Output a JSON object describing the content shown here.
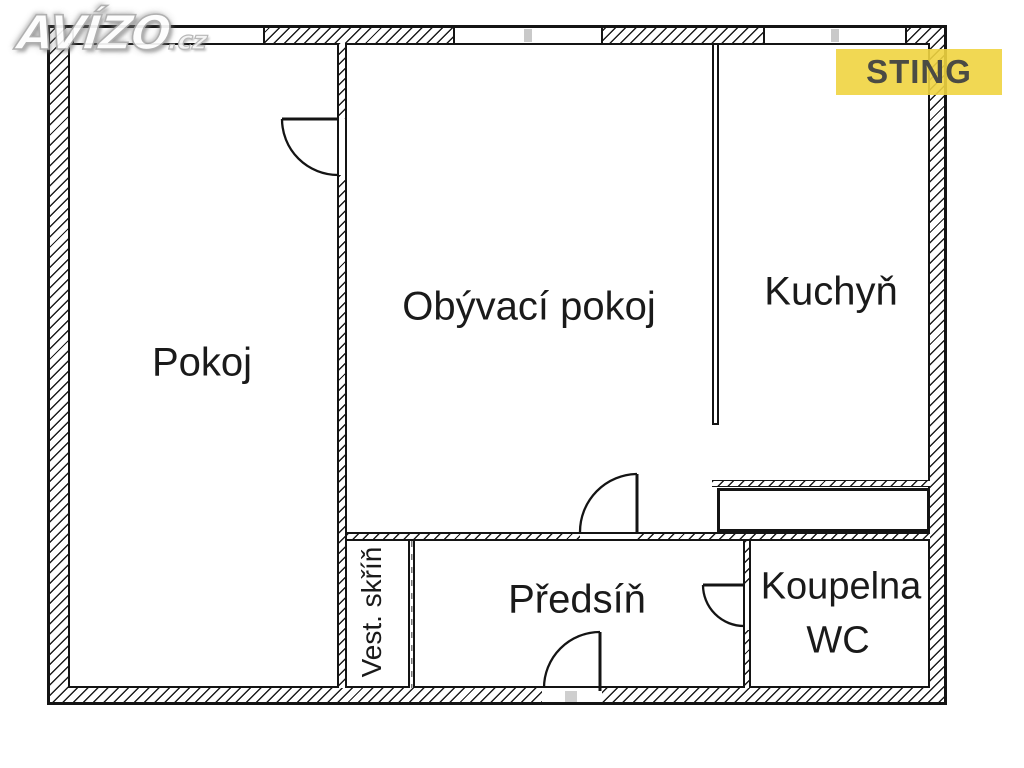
{
  "watermark": {
    "name": "AVÍZO",
    "tld": ".cz"
  },
  "badge": {
    "label": "STING",
    "bg_color": "#efd440",
    "text_color": "#4b4b44"
  },
  "rooms": {
    "pokoj": "Pokoj",
    "obyvaci_pokoj": "Obývací pokoj",
    "kuchyn": "Kuchyň",
    "predsin": "Předsíň",
    "koupelna_line1": "Koupelna",
    "koupelna_line2": "WC",
    "vest_skrin": "Vest. skříň"
  },
  "colors": {
    "wall_line": "#141414",
    "window_mullion": "#c9c9c9"
  }
}
